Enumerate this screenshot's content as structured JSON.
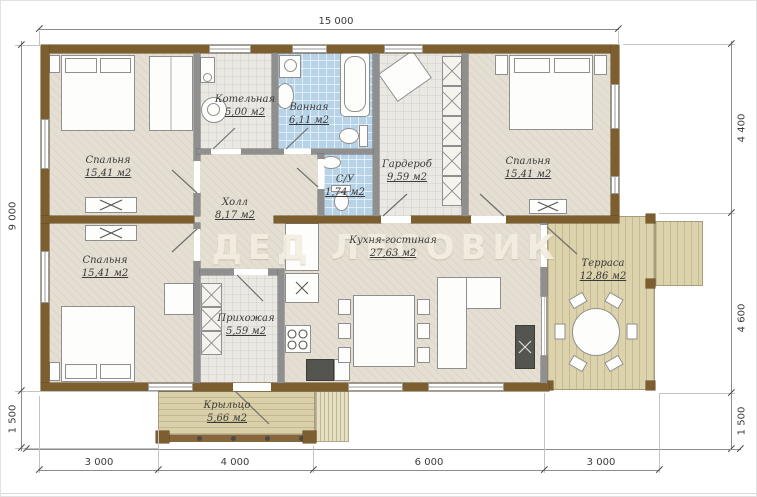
{
  "watermark": "ДЕД ЛЕСОВИК",
  "dimensions": {
    "top": [
      "15 000"
    ],
    "left": [
      "9 000",
      "1 500"
    ],
    "right": [
      "4 400",
      "4 600",
      "1 500"
    ],
    "bottom": [
      "3 000",
      "4 000",
      "6 000",
      "3 000"
    ]
  },
  "rooms": [
    {
      "name": "Спальня",
      "area": "15,41 м2"
    },
    {
      "name": "Котельная",
      "area": "5,00 м2"
    },
    {
      "name": "Ванная",
      "area": "6,11 м2"
    },
    {
      "name": "Гардероб",
      "area": "9,59 м2"
    },
    {
      "name": "Спальня",
      "area": "15,41 м2"
    },
    {
      "name": "С/У",
      "area": "1,74 м2"
    },
    {
      "name": "Холл",
      "area": "8,17 м2"
    },
    {
      "name": "Спальня",
      "area": "15,41 м2"
    },
    {
      "name": "Прихожая",
      "area": "5,59 м2"
    },
    {
      "name": "Кухня-гостиная",
      "area": "27,63 м2"
    },
    {
      "name": "Терраса",
      "area": "12,86 м2"
    },
    {
      "name": "Крыльцо",
      "area": "5,66 м2"
    }
  ],
  "colors": {
    "wall_brown": "#7d5e2f",
    "partition_grey": "#8f8f8f",
    "floor_beige": "#e4dfd2",
    "tile_grey": "#eae8e2",
    "wet_blue": "#b7d3e8",
    "deck_tan": "#dcd2ab",
    "dimension_text": "#3c3c3c",
    "watermark_cream": "#f6f1e5"
  }
}
